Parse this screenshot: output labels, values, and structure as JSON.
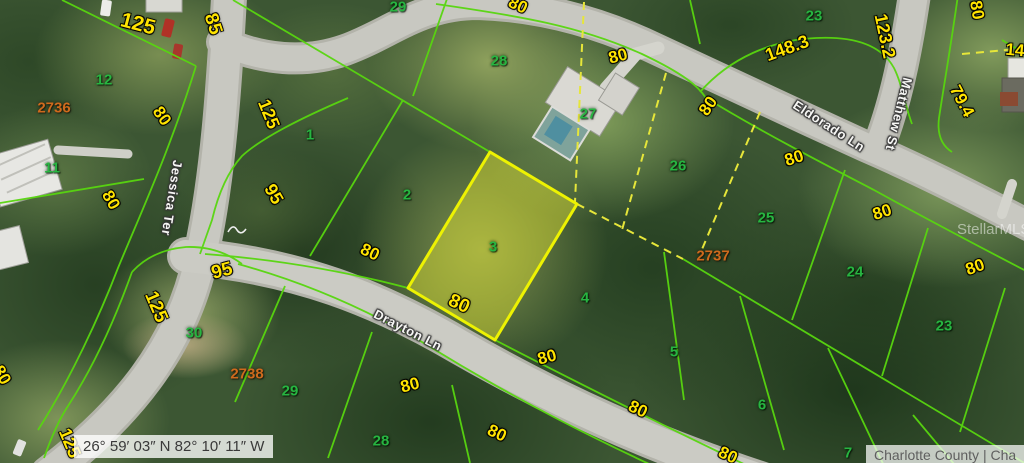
{
  "map": {
    "streets": [
      {
        "name": "Jessica Ter",
        "x": 172,
        "y": 198,
        "rot": 99
      },
      {
        "name": "Drayton Ln",
        "x": 408,
        "y": 330,
        "rot": 27
      },
      {
        "name": "Eldorado Ln",
        "x": 829,
        "y": 126,
        "rot": 33
      },
      {
        "name": "Matthew St",
        "x": 899,
        "y": 114,
        "rot": 104
      }
    ],
    "lots": [
      {
        "n": "12",
        "x": 104,
        "y": 80
      },
      {
        "n": "11",
        "x": 52,
        "y": 168
      },
      {
        "n": "1",
        "x": 310,
        "y": 135
      },
      {
        "n": "2",
        "x": 407,
        "y": 195
      },
      {
        "n": "3",
        "x": 493,
        "y": 247
      },
      {
        "n": "4",
        "x": 585,
        "y": 298
      },
      {
        "n": "5",
        "x": 674,
        "y": 352
      },
      {
        "n": "6",
        "x": 762,
        "y": 405
      },
      {
        "n": "7",
        "x": 848,
        "y": 453
      },
      {
        "n": "29",
        "x": 398,
        "y": 7
      },
      {
        "n": "28",
        "x": 499,
        "y": 61
      },
      {
        "n": "27",
        "x": 588,
        "y": 114
      },
      {
        "n": "26",
        "x": 678,
        "y": 166
      },
      {
        "n": "25",
        "x": 766,
        "y": 218
      },
      {
        "n": "24",
        "x": 855,
        "y": 272
      },
      {
        "n": "23",
        "x": 944,
        "y": 326
      },
      {
        "n": "23",
        "x": 814,
        "y": 16
      },
      {
        "n": "30",
        "x": 194,
        "y": 333
      },
      {
        "n": "29",
        "x": 290,
        "y": 391
      },
      {
        "n": "28",
        "x": 381,
        "y": 441
      }
    ],
    "dimensions": [
      {
        "t": "125",
        "x": 138,
        "y": 24,
        "r": 15,
        "s": 21
      },
      {
        "t": "85",
        "x": 213,
        "y": 24,
        "r": 72,
        "s": 19
      },
      {
        "t": "80",
        "x": 162,
        "y": 116,
        "r": 55
      },
      {
        "t": "80",
        "x": 111,
        "y": 200,
        "r": 60
      },
      {
        "t": "80",
        "x": 2,
        "y": 375,
        "r": 60
      },
      {
        "t": "125",
        "x": 269,
        "y": 114,
        "r": 68,
        "s": 18
      },
      {
        "t": "95",
        "x": 274,
        "y": 194,
        "r": 60,
        "s": 18
      },
      {
        "t": "95",
        "x": 222,
        "y": 271,
        "r": -15,
        "s": 19
      },
      {
        "t": "125",
        "x": 156,
        "y": 307,
        "r": 67,
        "s": 19
      },
      {
        "t": "125",
        "x": 70,
        "y": 443,
        "r": 67,
        "s": 18
      },
      {
        "t": "80",
        "x": 518,
        "y": 5,
        "r": 25
      },
      {
        "t": "80",
        "x": 618,
        "y": 56,
        "r": -15
      },
      {
        "t": "80",
        "x": 794,
        "y": 158,
        "r": -18
      },
      {
        "t": "80",
        "x": 882,
        "y": 212,
        "r": -18
      },
      {
        "t": "148.3",
        "x": 787,
        "y": 48,
        "r": -20,
        "s": 18
      },
      {
        "t": "123.2",
        "x": 885,
        "y": 36,
        "r": 78,
        "s": 18
      },
      {
        "t": "80",
        "x": 977,
        "y": 10,
        "r": 80
      },
      {
        "t": "79.4",
        "x": 962,
        "y": 101,
        "r": 62
      },
      {
        "t": "14",
        "x": 1015,
        "y": 50,
        "r": 5
      },
      {
        "t": "80",
        "x": 708,
        "y": 106,
        "r": -55
      },
      {
        "t": "80",
        "x": 975,
        "y": 267,
        "r": -20
      },
      {
        "t": "80",
        "x": 459,
        "y": 304,
        "r": 25,
        "s": 19
      },
      {
        "t": "80",
        "x": 370,
        "y": 252,
        "r": 25
      },
      {
        "t": "80",
        "x": 547,
        "y": 357,
        "r": -15
      },
      {
        "t": "80",
        "x": 638,
        "y": 409,
        "r": 25
      },
      {
        "t": "80",
        "x": 410,
        "y": 385,
        "r": -15
      },
      {
        "t": "80",
        "x": 497,
        "y": 433,
        "r": 25
      },
      {
        "t": "80",
        "x": 728,
        "y": 455,
        "r": 25
      }
    ],
    "plats": [
      {
        "t": "2736",
        "x": 54,
        "y": 108
      },
      {
        "t": "2737",
        "x": 713,
        "y": 256
      },
      {
        "t": "2738",
        "x": 247,
        "y": 374
      }
    ],
    "subject_lot_number": "3",
    "coordinates": "26° 59′ 03″ N 82° 10′ 11″ W",
    "attribution": "Charlotte County | Cha",
    "watermark": "StellarMLS",
    "colors": {
      "parcel_line": "#58d60f",
      "dashed_line": "#e6e63a",
      "subject_fill": "rgba(238,238,50,0.42)",
      "subject_stroke": "#edf202",
      "dimension_text": "#ffe400",
      "lot_text": "#27b541",
      "plat_text": "#cf6a1d",
      "road": "#c8c8c1"
    }
  }
}
